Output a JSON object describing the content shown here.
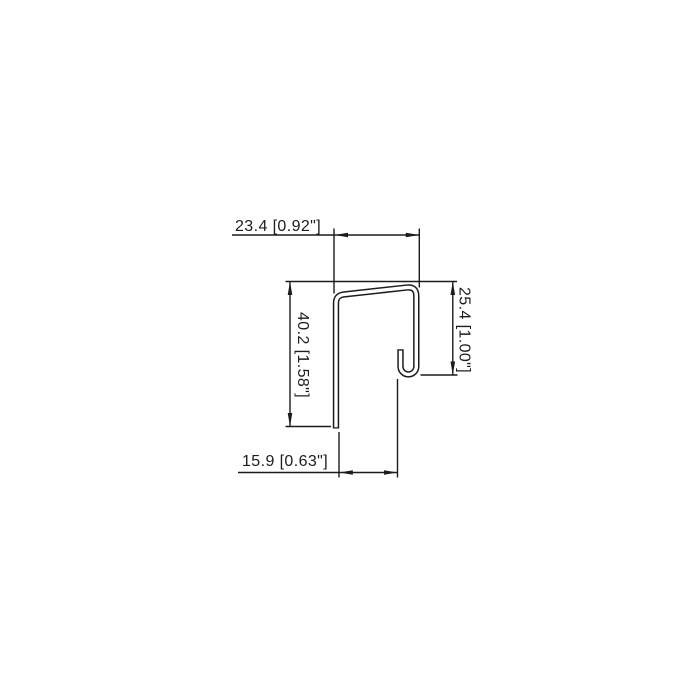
{
  "page": {
    "background": "#ffffff",
    "line_color": "#1c1c1c"
  },
  "drawing": {
    "type": "profile-cross-section-technical-drawing",
    "dimensions": {
      "top": {
        "label": "23.4 [0.92\"]",
        "value_mm": "23.4",
        "value_in": "0.92\""
      },
      "left": {
        "label": "40.2 [1.58\"]",
        "value_mm": "40.2",
        "value_in": "1.58\""
      },
      "right": {
        "label": "25.4 [1.00\"]",
        "value_mm": "25.4",
        "value_in": "1.00\""
      },
      "bottom": {
        "label": "15.9 [0.63\"]",
        "value_mm": "15.9",
        "value_in": "0.63\""
      }
    }
  }
}
